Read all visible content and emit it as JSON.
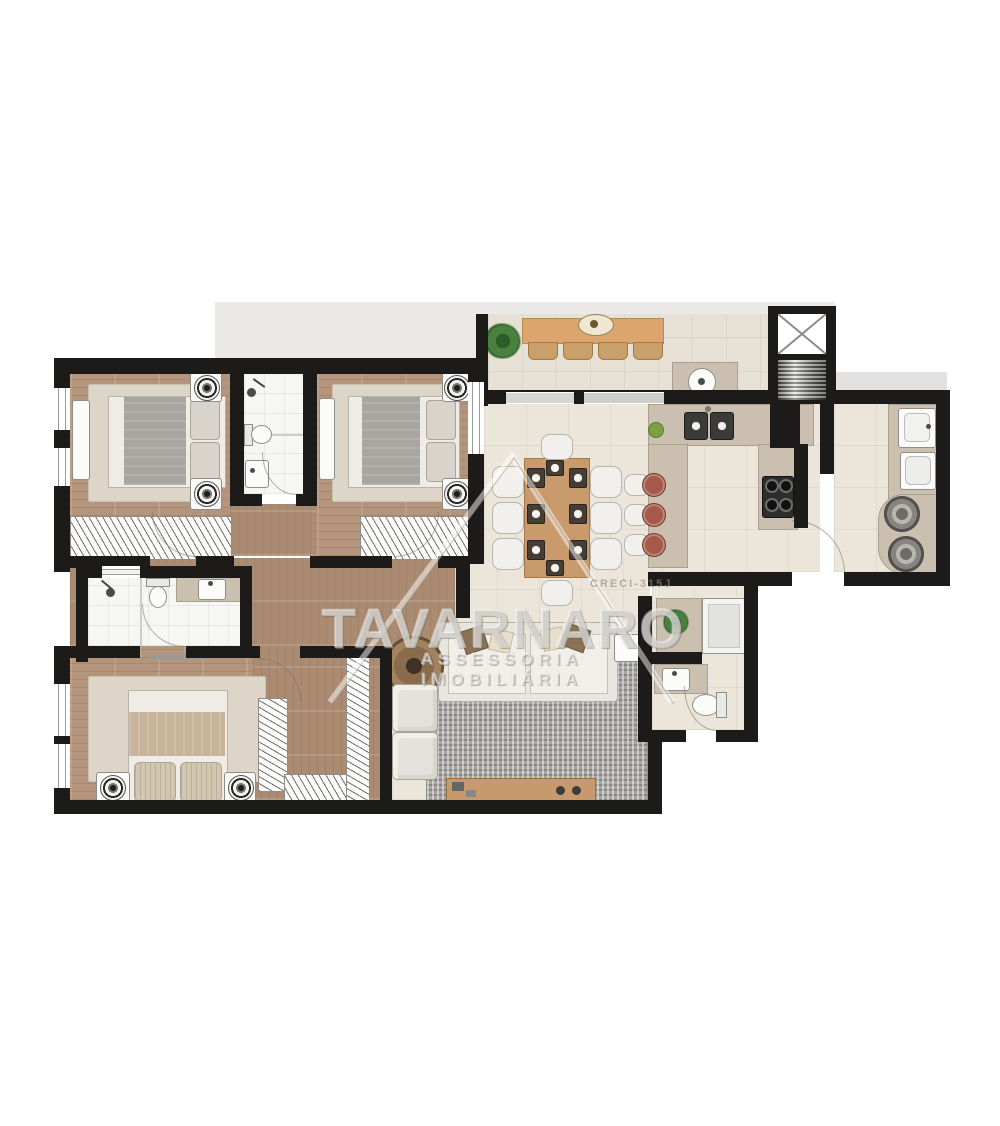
{
  "watermark": {
    "brand": "TAVARNARO",
    "subtitle": "ASSESSORIA IMOBILIÁRIA",
    "license": "CRECI-315J"
  },
  "palette": {
    "wall": "#1d1b19",
    "wood_floor": "#b4947a",
    "tile_floor": "#ece6da",
    "bath_floor": "#f6f6f3",
    "terrace_floor": "#e7e1d5",
    "backdrop_gray": "#eae9e7",
    "counter_tan": "#cbc0af",
    "furniture_wood": "#c79a6d",
    "rug_beige": "#ddd5c7",
    "rug_mosaic_gray": "#a7a6a3",
    "stool_red": "#a6594a",
    "plant_green": "#4a8040",
    "watermark_white": "rgba(255,255,255,0.42)"
  },
  "plan": {
    "kind": "residential-apartment-floor-plan",
    "rooms": [
      "bedroom-1",
      "shared-bathroom",
      "bedroom-2",
      "gourmet-balcony",
      "elevator",
      "kitchen",
      "service-area",
      "dining-room",
      "living-room",
      "hallway",
      "ensuite-bathroom",
      "master-bedroom",
      "walk-in-closet",
      "powder-room"
    ]
  }
}
